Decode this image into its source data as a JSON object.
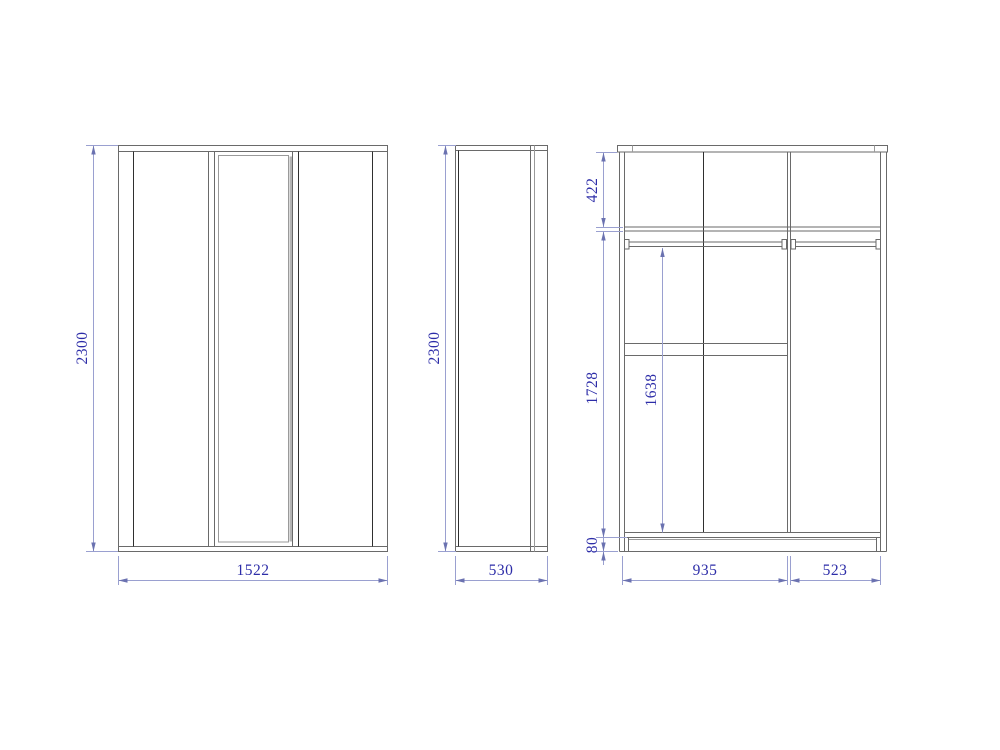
{
  "drawing": {
    "type": "furniture-technical-drawing",
    "subject": "three-door wardrobe orthographic views with dimensions",
    "units": "mm",
    "colors": {
      "background": "#ffffff",
      "outline": "#6a6a6a",
      "dark_edge": "#2f2f2f",
      "light_edge": "#9a9a9a",
      "mirror_accent": "#b5b5b5",
      "dimension_line": "#9aa0d0",
      "dimension_arrow": "#6b72b0",
      "dimension_text": "#2d2da8"
    },
    "views": {
      "front": {
        "name": "front view",
        "height_mm": "2300",
        "width_mm": "1522"
      },
      "side": {
        "name": "side view",
        "height_mm": "2300",
        "depth_mm": "530"
      },
      "internal": {
        "name": "internal section view",
        "top_section_mm": "422",
        "lower_section_mm": "1728",
        "hanging_clearance_mm": "1638",
        "plinth_mm": "80",
        "left_compartment_mm": "935",
        "right_compartment_mm": "523"
      }
    }
  }
}
